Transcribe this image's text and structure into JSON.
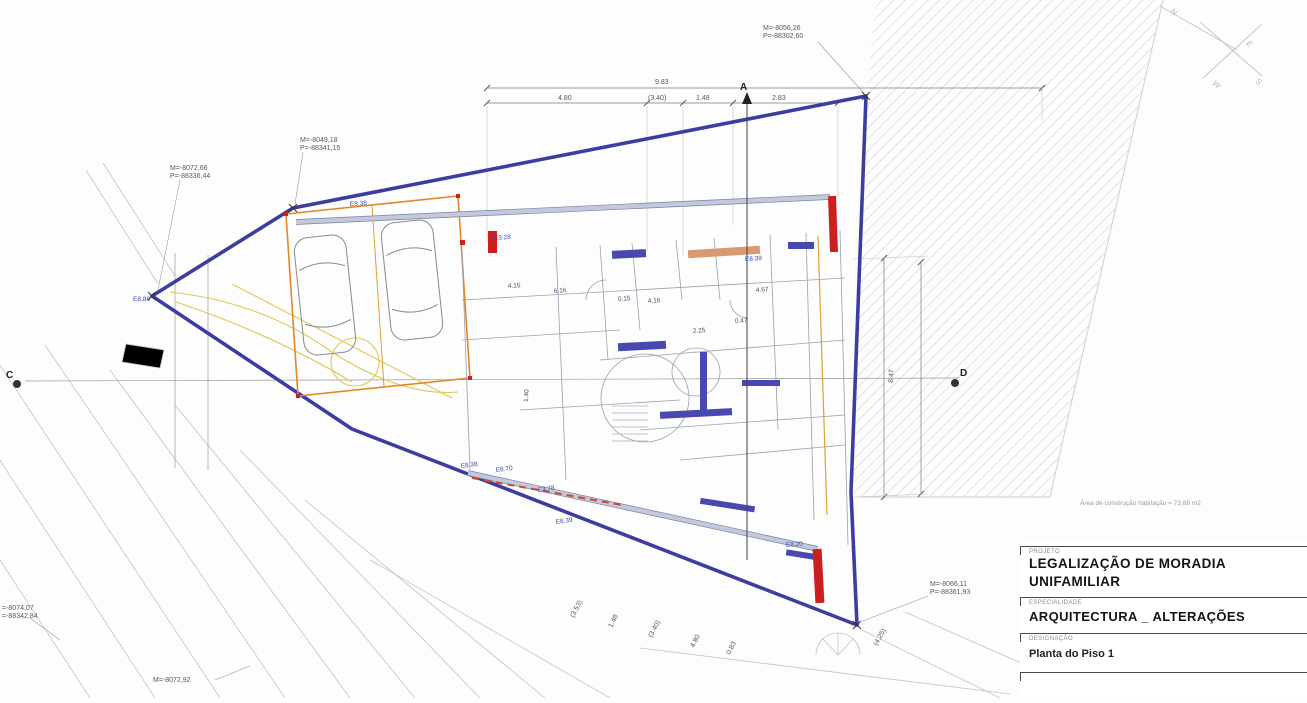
{
  "coords": {
    "top_right": {
      "m": "M=-8056,26",
      "p": "P=-88302,60"
    },
    "upper_left": {
      "m": "M=-8049,18",
      "p": "P=-88341,15"
    },
    "left": {
      "m": "M=-8072,66",
      "p": "P=-88336,44"
    },
    "bottom_right": {
      "m": "M=-8066,11",
      "p": "P=-88361,93"
    },
    "left_edge": {
      "m": "=-8074,07",
      "p": "=-88342,84"
    },
    "bottom_left": {
      "m": "M=-8072,92"
    }
  },
  "dims": {
    "top_total": "9.83",
    "top1": "4.80",
    "top2": "(3.40)",
    "top3": "1.48",
    "top4": "2.83",
    "right_v": "8.47",
    "bot1": "(3.53)",
    "bot2": "1.48",
    "bot3": "(3.40)",
    "bot4": "4.80",
    "bot5": "0.83",
    "bot6": "(4.25)"
  },
  "markers": {
    "a": "A",
    "c": "C",
    "d": "D"
  },
  "compass": {
    "n": "N",
    "e": "E",
    "s": "S",
    "w": "W"
  },
  "note": "Área de construção habitação = 73,68 m2",
  "title_block": {
    "project_label": "PROJETO",
    "project_line1": "LEGALIZAÇÃO DE MORADIA",
    "project_line2": "UNIFAMILIAR",
    "specialty_label": "ESPECIALIDADE",
    "specialty": "ARQUITECTURA _ ALTERAÇÕES",
    "designation_label": "DESIGNAÇÃO",
    "designation": "Planta do Piso 1"
  },
  "plan_annotations": [
    "E8.38",
    "E8.88",
    "E3.28",
    "E8.10",
    "E8.39",
    "4.15",
    "6.16",
    "0.15",
    "4.16",
    "4.67",
    "0.47",
    "2.25",
    "1.40",
    "E8.38",
    "E8.70",
    "E3.78",
    "E8.39",
    "E8.20"
  ]
}
